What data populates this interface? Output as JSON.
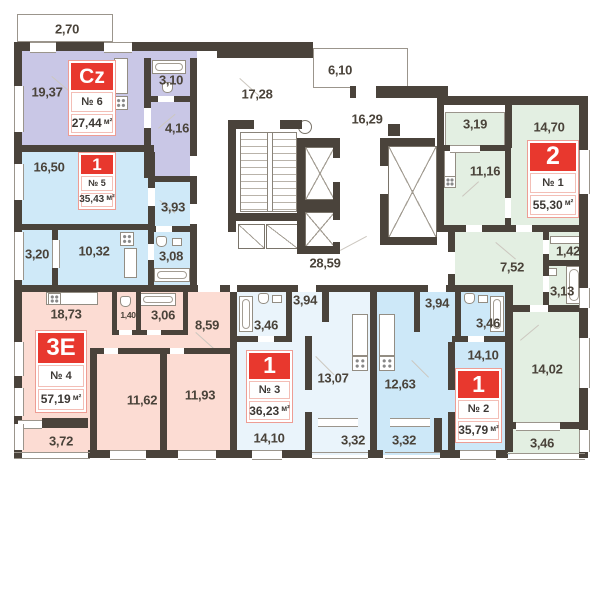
{
  "colors": {
    "wall": "#4a433b",
    "label_text": "#4a433a",
    "badge_red": "#e8382e",
    "badge_border": "#ee9d94",
    "apt6_fill": "#c9c7e6",
    "apt5_fill": "#cfe9f8",
    "apt4_fill": "#fcdcd3",
    "apt3_fill": "#eaf4fb",
    "apt2_fill": "#cde8f8",
    "apt1_fill": "#e3efe2"
  },
  "apartments": [
    {
      "key": "apt6",
      "type": "Cz",
      "number": "№ 6",
      "area": "27,44",
      "unit": "м²",
      "rooms": [
        {
          "name": "balcony",
          "label": "2,70"
        },
        {
          "name": "living",
          "label": "19,37"
        },
        {
          "name": "bathroom",
          "label": "3,10"
        },
        {
          "name": "hall",
          "label": "4,16"
        }
      ]
    },
    {
      "key": "apt5",
      "type": "1",
      "number": "№ 5",
      "area": "35,43",
      "unit": "м²",
      "rooms": [
        {
          "name": "living",
          "label": "16,50"
        },
        {
          "name": "hall",
          "label": "3,93"
        },
        {
          "name": "loggia",
          "label": "3,20"
        },
        {
          "name": "kitchen",
          "label": "10,32"
        },
        {
          "name": "bathroom",
          "label": "3,08"
        }
      ]
    },
    {
      "key": "apt4",
      "type": "3E",
      "number": "№ 4",
      "area": "57,19",
      "unit": "м²",
      "rooms": [
        {
          "name": "kitchen-living",
          "label": "18,73"
        },
        {
          "name": "wc",
          "label": "1,40"
        },
        {
          "name": "bathroom",
          "label": "3,06"
        },
        {
          "name": "hall",
          "label": "8,59"
        },
        {
          "name": "bedroom-1",
          "label": "11,62"
        },
        {
          "name": "bedroom-2",
          "label": "11,93"
        },
        {
          "name": "loggia",
          "label": "3,72"
        }
      ]
    },
    {
      "key": "apt3",
      "type": "1",
      "number": "№ 3",
      "area": "36,23",
      "unit": "м²",
      "rooms": [
        {
          "name": "hall",
          "label": "3,94"
        },
        {
          "name": "bathroom",
          "label": "3,46"
        },
        {
          "name": "kitchen-living",
          "label": "13,07"
        },
        {
          "name": "bedroom",
          "label": "14,10"
        },
        {
          "name": "loggia",
          "label": "3,32"
        }
      ]
    },
    {
      "key": "apt2",
      "type": "1",
      "number": "№ 2",
      "area": "35,79",
      "unit": "м²",
      "rooms": [
        {
          "name": "hall",
          "label": "3,94"
        },
        {
          "name": "bathroom",
          "label": "3,46"
        },
        {
          "name": "kitchen-living",
          "label": "12,63"
        },
        {
          "name": "bedroom",
          "label": "14,10"
        },
        {
          "name": "loggia",
          "label": "3,32"
        }
      ]
    },
    {
      "key": "apt1",
      "type": "2",
      "number": "№ 1",
      "area": "55,30",
      "unit": "м²",
      "rooms": [
        {
          "name": "loggia-top",
          "label": "3,19"
        },
        {
          "name": "bedroom",
          "label": "14,70"
        },
        {
          "name": "kitchen",
          "label": "11,16"
        },
        {
          "name": "hall",
          "label": "7,52"
        },
        {
          "name": "storage",
          "label": "1,42"
        },
        {
          "name": "bathroom",
          "label": "3,13"
        },
        {
          "name": "living",
          "label": "14,02"
        },
        {
          "name": "loggia-bottom",
          "label": "3,46"
        }
      ]
    }
  ],
  "common_areas": [
    {
      "name": "stair-hall",
      "label": "17,28"
    },
    {
      "name": "balcony",
      "label": "6,10"
    },
    {
      "name": "lift-hall",
      "label": "16,29"
    },
    {
      "name": "corridor",
      "label": "28,59"
    }
  ]
}
